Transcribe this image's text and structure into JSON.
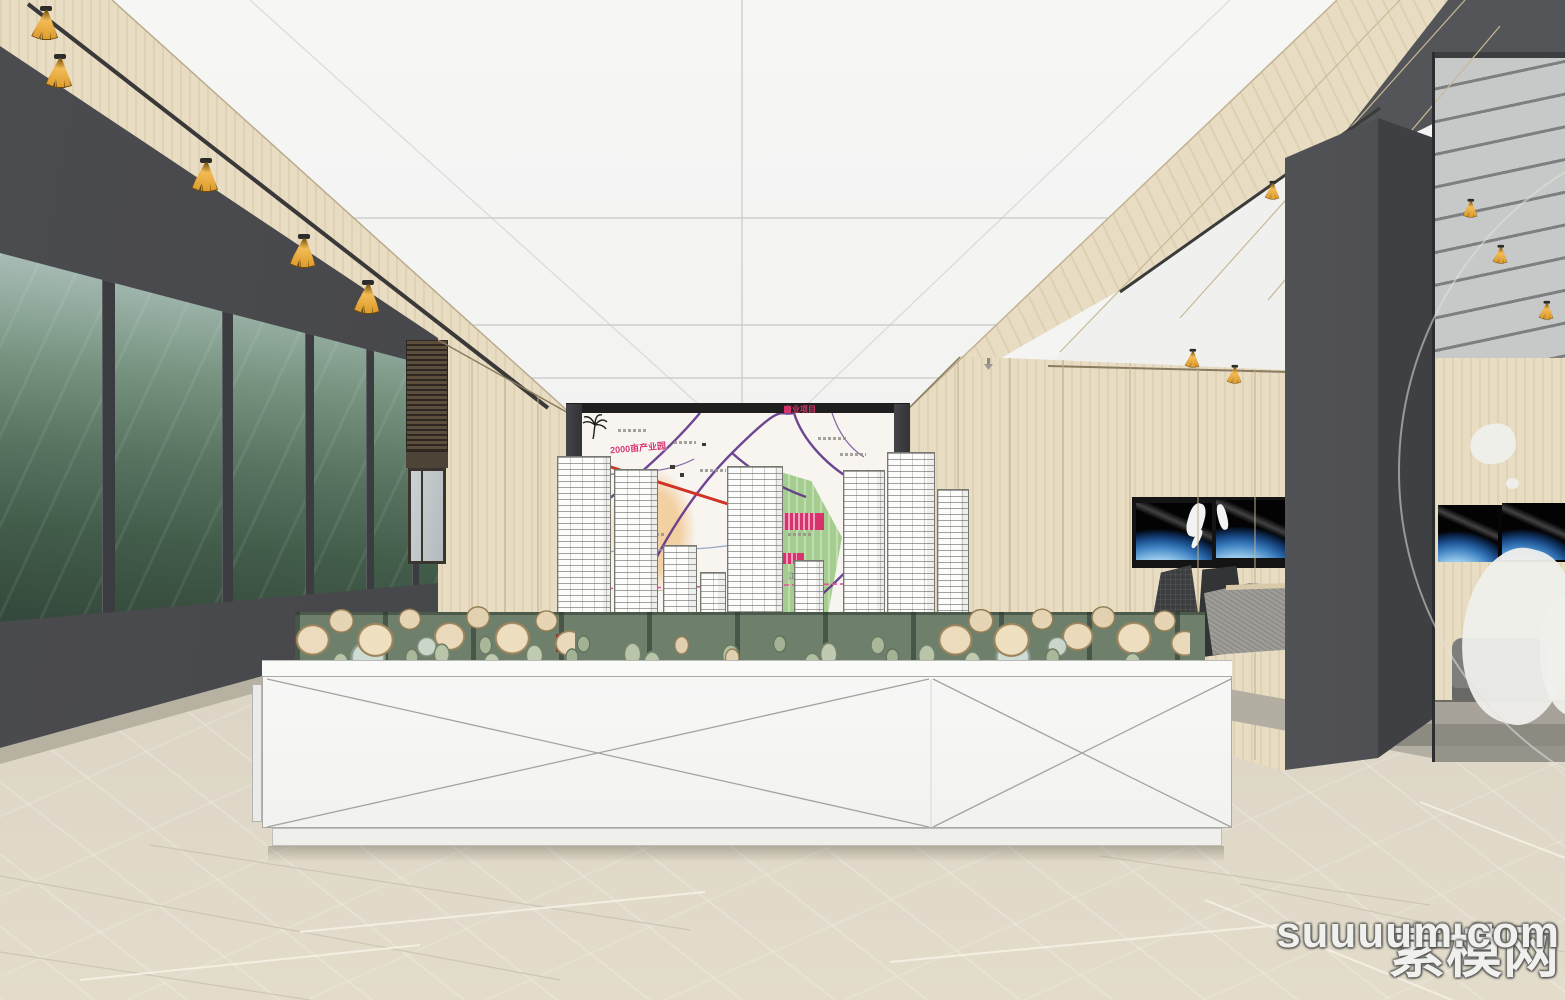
{
  "watermark": {
    "site_cn": "素模网",
    "site_en": "suuuum.com"
  },
  "map_board": {
    "legend": {
      "icon": "pink-square",
      "label": "产业项目"
    },
    "labels": [
      {
        "text": "2000亩产业园"
      },
      {
        "text": "江苏"
      }
    ],
    "colors": {
      "road_purple": "#5e3387",
      "road_red": "#d03326",
      "zone_orange": "#f3cf9f",
      "zone_green": "#a5cd8f",
      "annotation_pink": "#d6336c"
    }
  },
  "palette": {
    "ceiling_white": "#f3f3f2",
    "wood": "#e8dcc2",
    "dark_wall": "#47484b",
    "floor_beige": "#ddd6c6",
    "spotlight_gold": "#e8ab45",
    "screen_city_teal": "#5d7a6a",
    "earth_blue": "#2f6cb0"
  }
}
